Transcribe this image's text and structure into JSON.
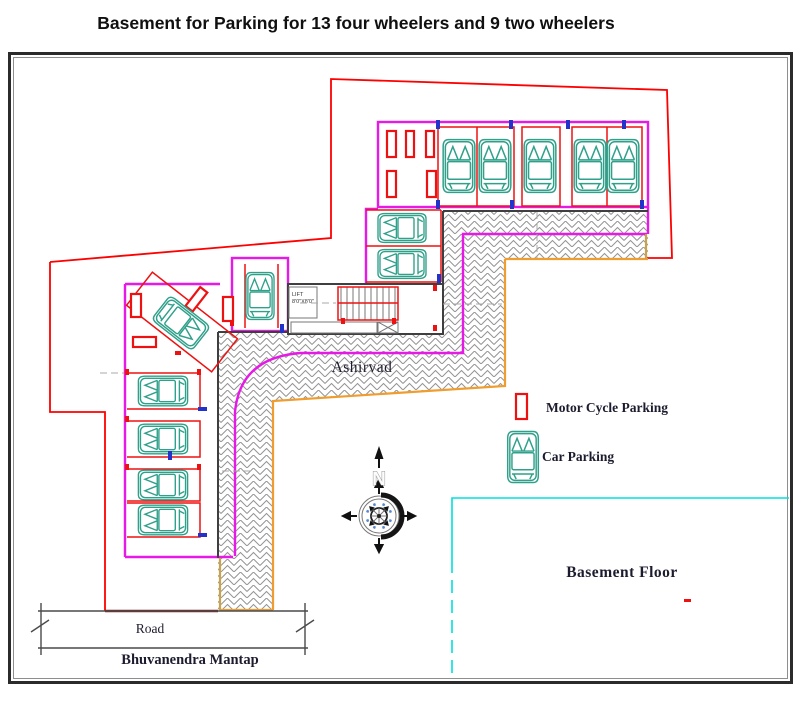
{
  "title": "Basement for Parking for 13 four wheelers and 9 two wheelers",
  "plan": {
    "building_label": "Ashirvad",
    "floor_label": "Basement Floor",
    "road_label": "Road",
    "frontage_label": "Bhuvanendra Mantap",
    "lift_label": "LIFT",
    "lift_size": "8'0\"X8'0\"",
    "compass_north_label": "N"
  },
  "legend": {
    "items": [
      {
        "id": "motorcycle-parking",
        "label": "Motor Cycle Parking"
      },
      {
        "id": "car-parking",
        "label": "Car Parking"
      }
    ]
  },
  "colors": {
    "boundary": "#fe0000",
    "wall": "#e619e6",
    "ramp": "#ef9d2e",
    "tan": "#c9a24b",
    "site": "#00e0e0",
    "car": "#2fa08a",
    "moto": "#ee1111",
    "ink": "#1c1c2e",
    "darkred": "#8b1a1a",
    "blue": "#2233cc"
  }
}
